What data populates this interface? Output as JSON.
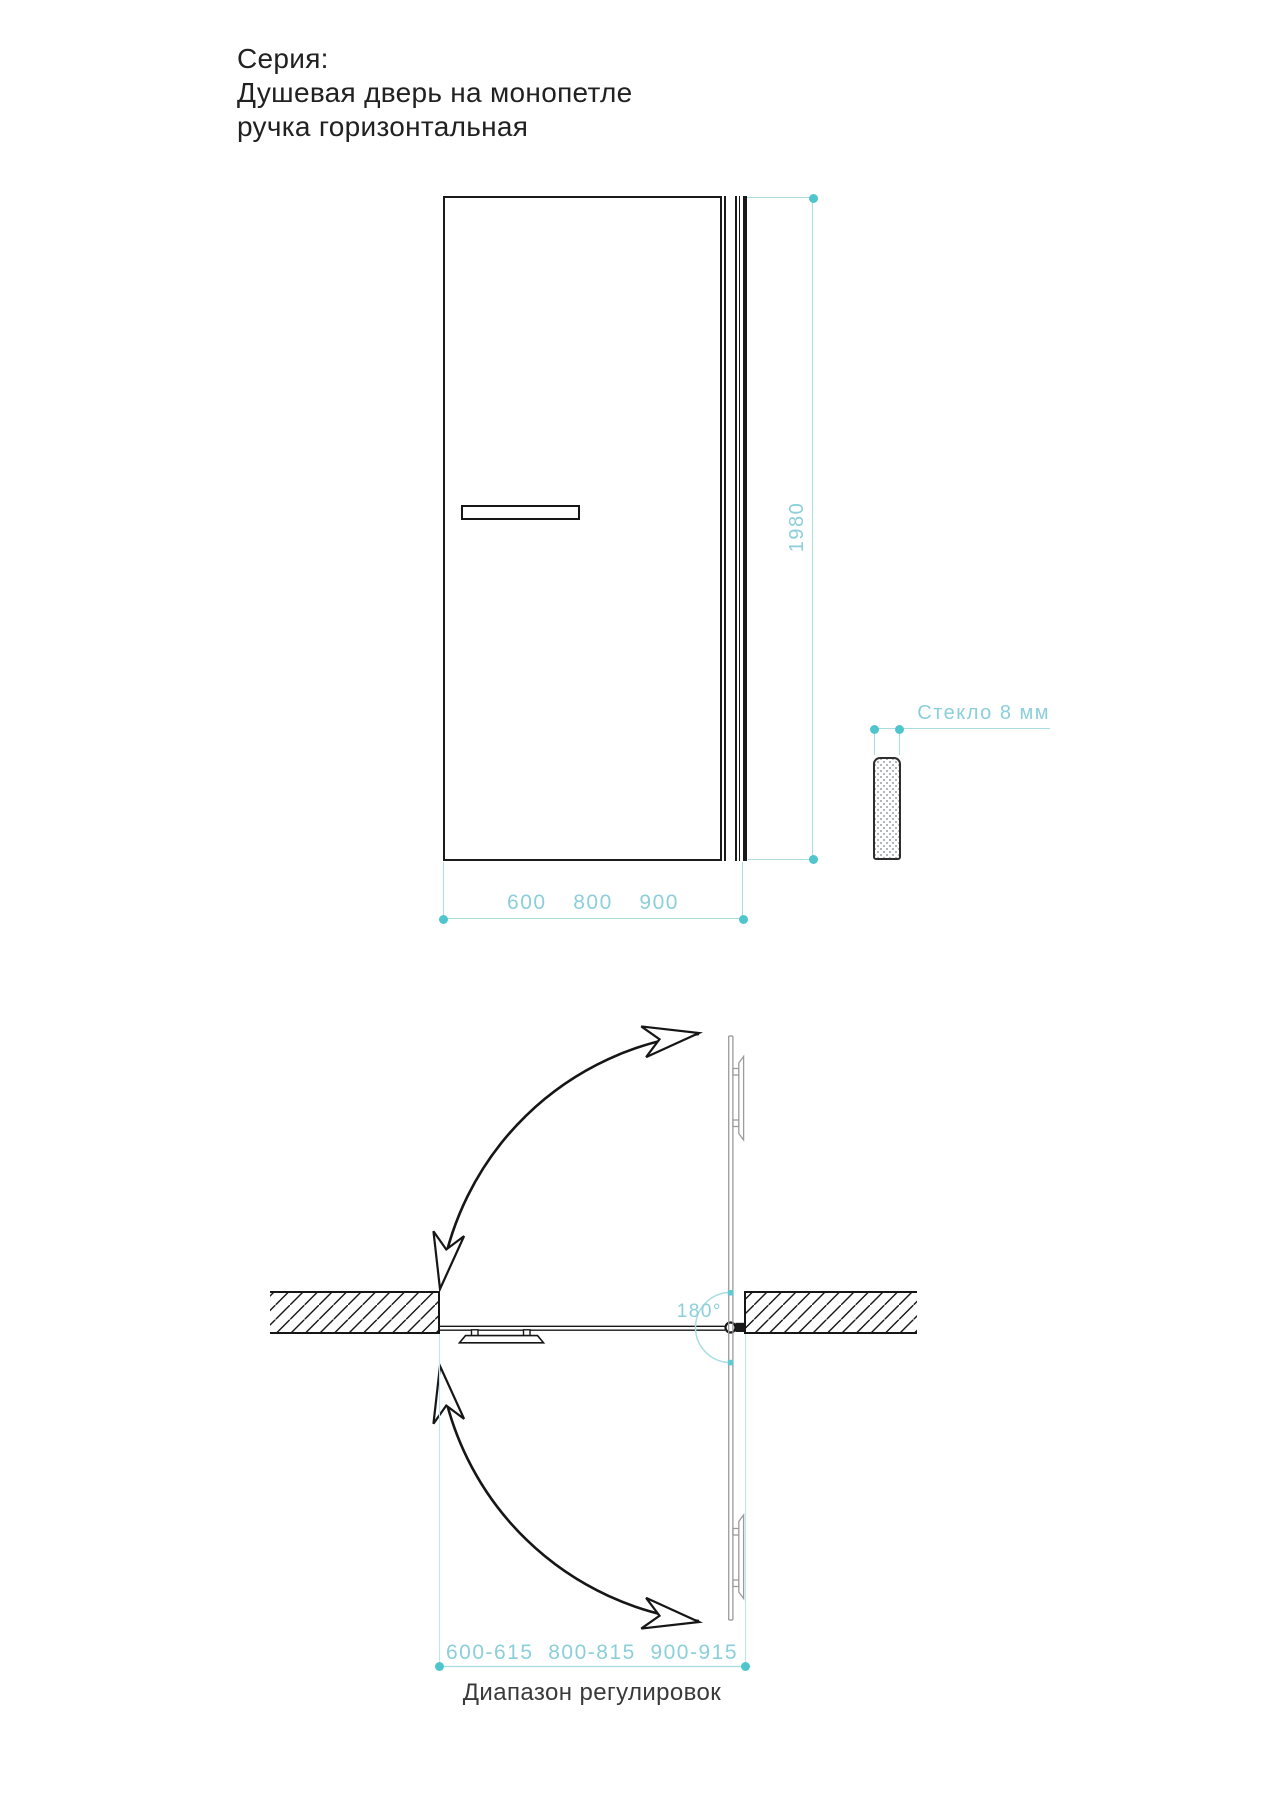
{
  "title": {
    "series_label": "Серия:",
    "product_line": "Душевая дверь на монопетле",
    "handle_line": "ручка горизонтальная"
  },
  "front_view": {
    "height_dim": "1980",
    "width_dims": "600  800  900",
    "glass_label": "Стекло 8 мм"
  },
  "plan_view": {
    "angle_label": "180°",
    "range_dims": "600-615  800-815  900-915",
    "caption": "Диапазон регулировок"
  },
  "colors": {
    "accent_teal_text": "#8bcfda",
    "accent_teal_line": "#a9dde2",
    "accent_teal_dot": "#4fc5cd",
    "drawing_black": "#1a1a1a",
    "open_door_gray": "#9c9c9c"
  }
}
